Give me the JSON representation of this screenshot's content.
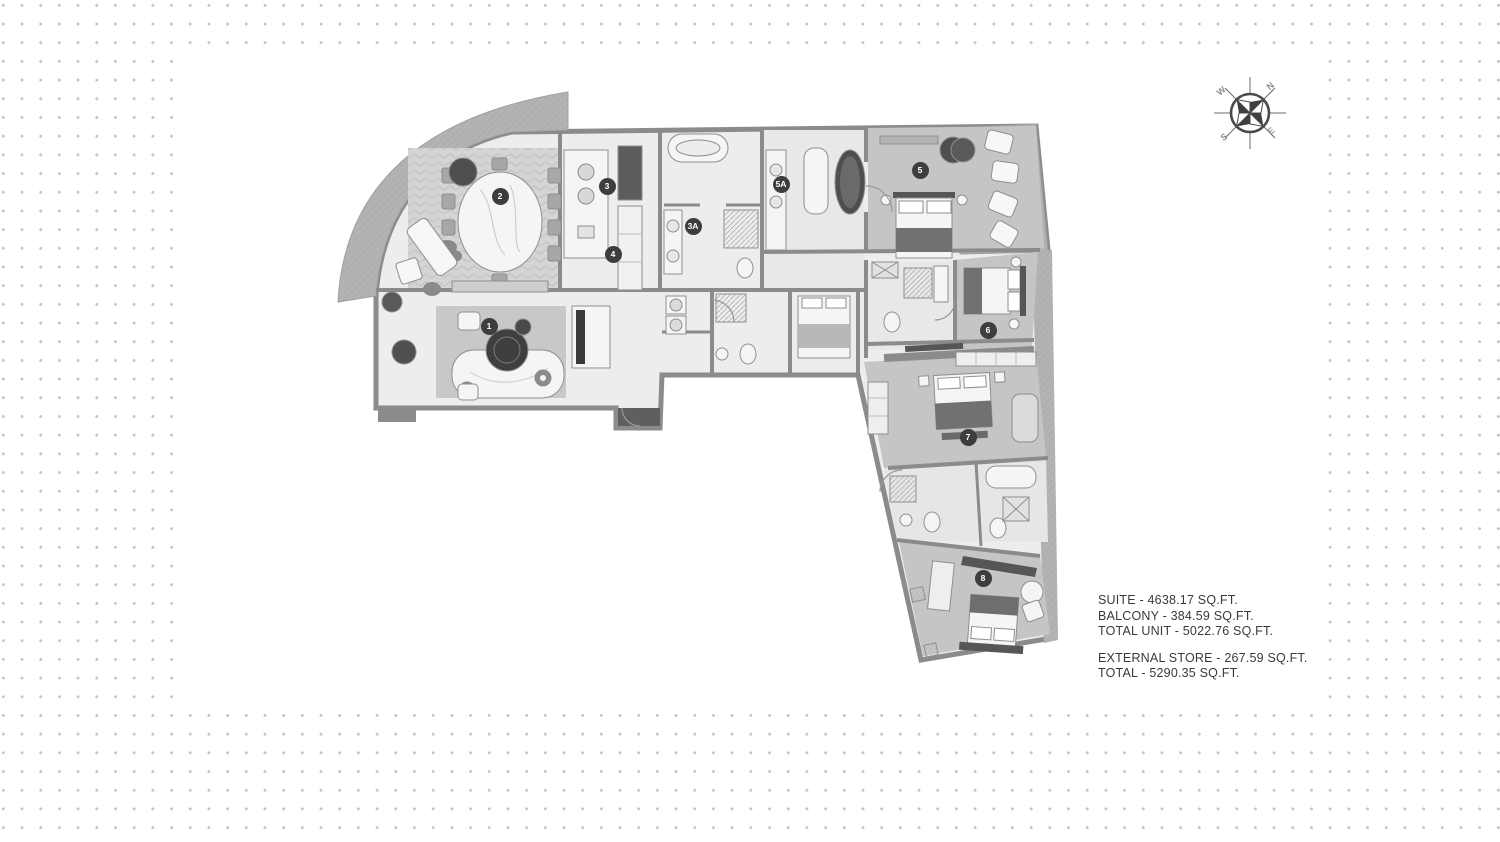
{
  "area_summary": {
    "lines": [
      "SUITE -  4638.17 SQ.FT.",
      "BALCONY -  384.59 SQ.FT.",
      "TOTAL UNIT -  5022.76 SQ.FT.",
      "EXTERNAL STORE -  267.59 SQ.FT.",
      "TOTAL -  5290.35 SQ.FT."
    ]
  },
  "compass": {
    "north": "N",
    "east": "E",
    "south": "S",
    "west": "W"
  },
  "floorplan": {
    "markers": [
      {
        "id": "1",
        "x": 489,
        "y": 326
      },
      {
        "id": "2",
        "x": 500,
        "y": 196
      },
      {
        "id": "3",
        "x": 607,
        "y": 186
      },
      {
        "id": "3A",
        "x": 693,
        "y": 226
      },
      {
        "id": "4",
        "x": 613,
        "y": 254
      },
      {
        "id": "5A",
        "x": 781,
        "y": 184
      },
      {
        "id": "5",
        "x": 920,
        "y": 170
      },
      {
        "id": "6",
        "x": 988,
        "y": 330
      },
      {
        "id": "7",
        "x": 968,
        "y": 437
      },
      {
        "id": "8",
        "x": 983,
        "y": 578
      }
    ],
    "colors": {
      "wall": "#8c8b89",
      "floor": "#eeedeb",
      "carpet": "#c6c5c3",
      "balcony": "#b4b3b1",
      "marker": "#3d3d3c",
      "dot": "#c3c3c3",
      "text": "#3a3a3a"
    }
  }
}
